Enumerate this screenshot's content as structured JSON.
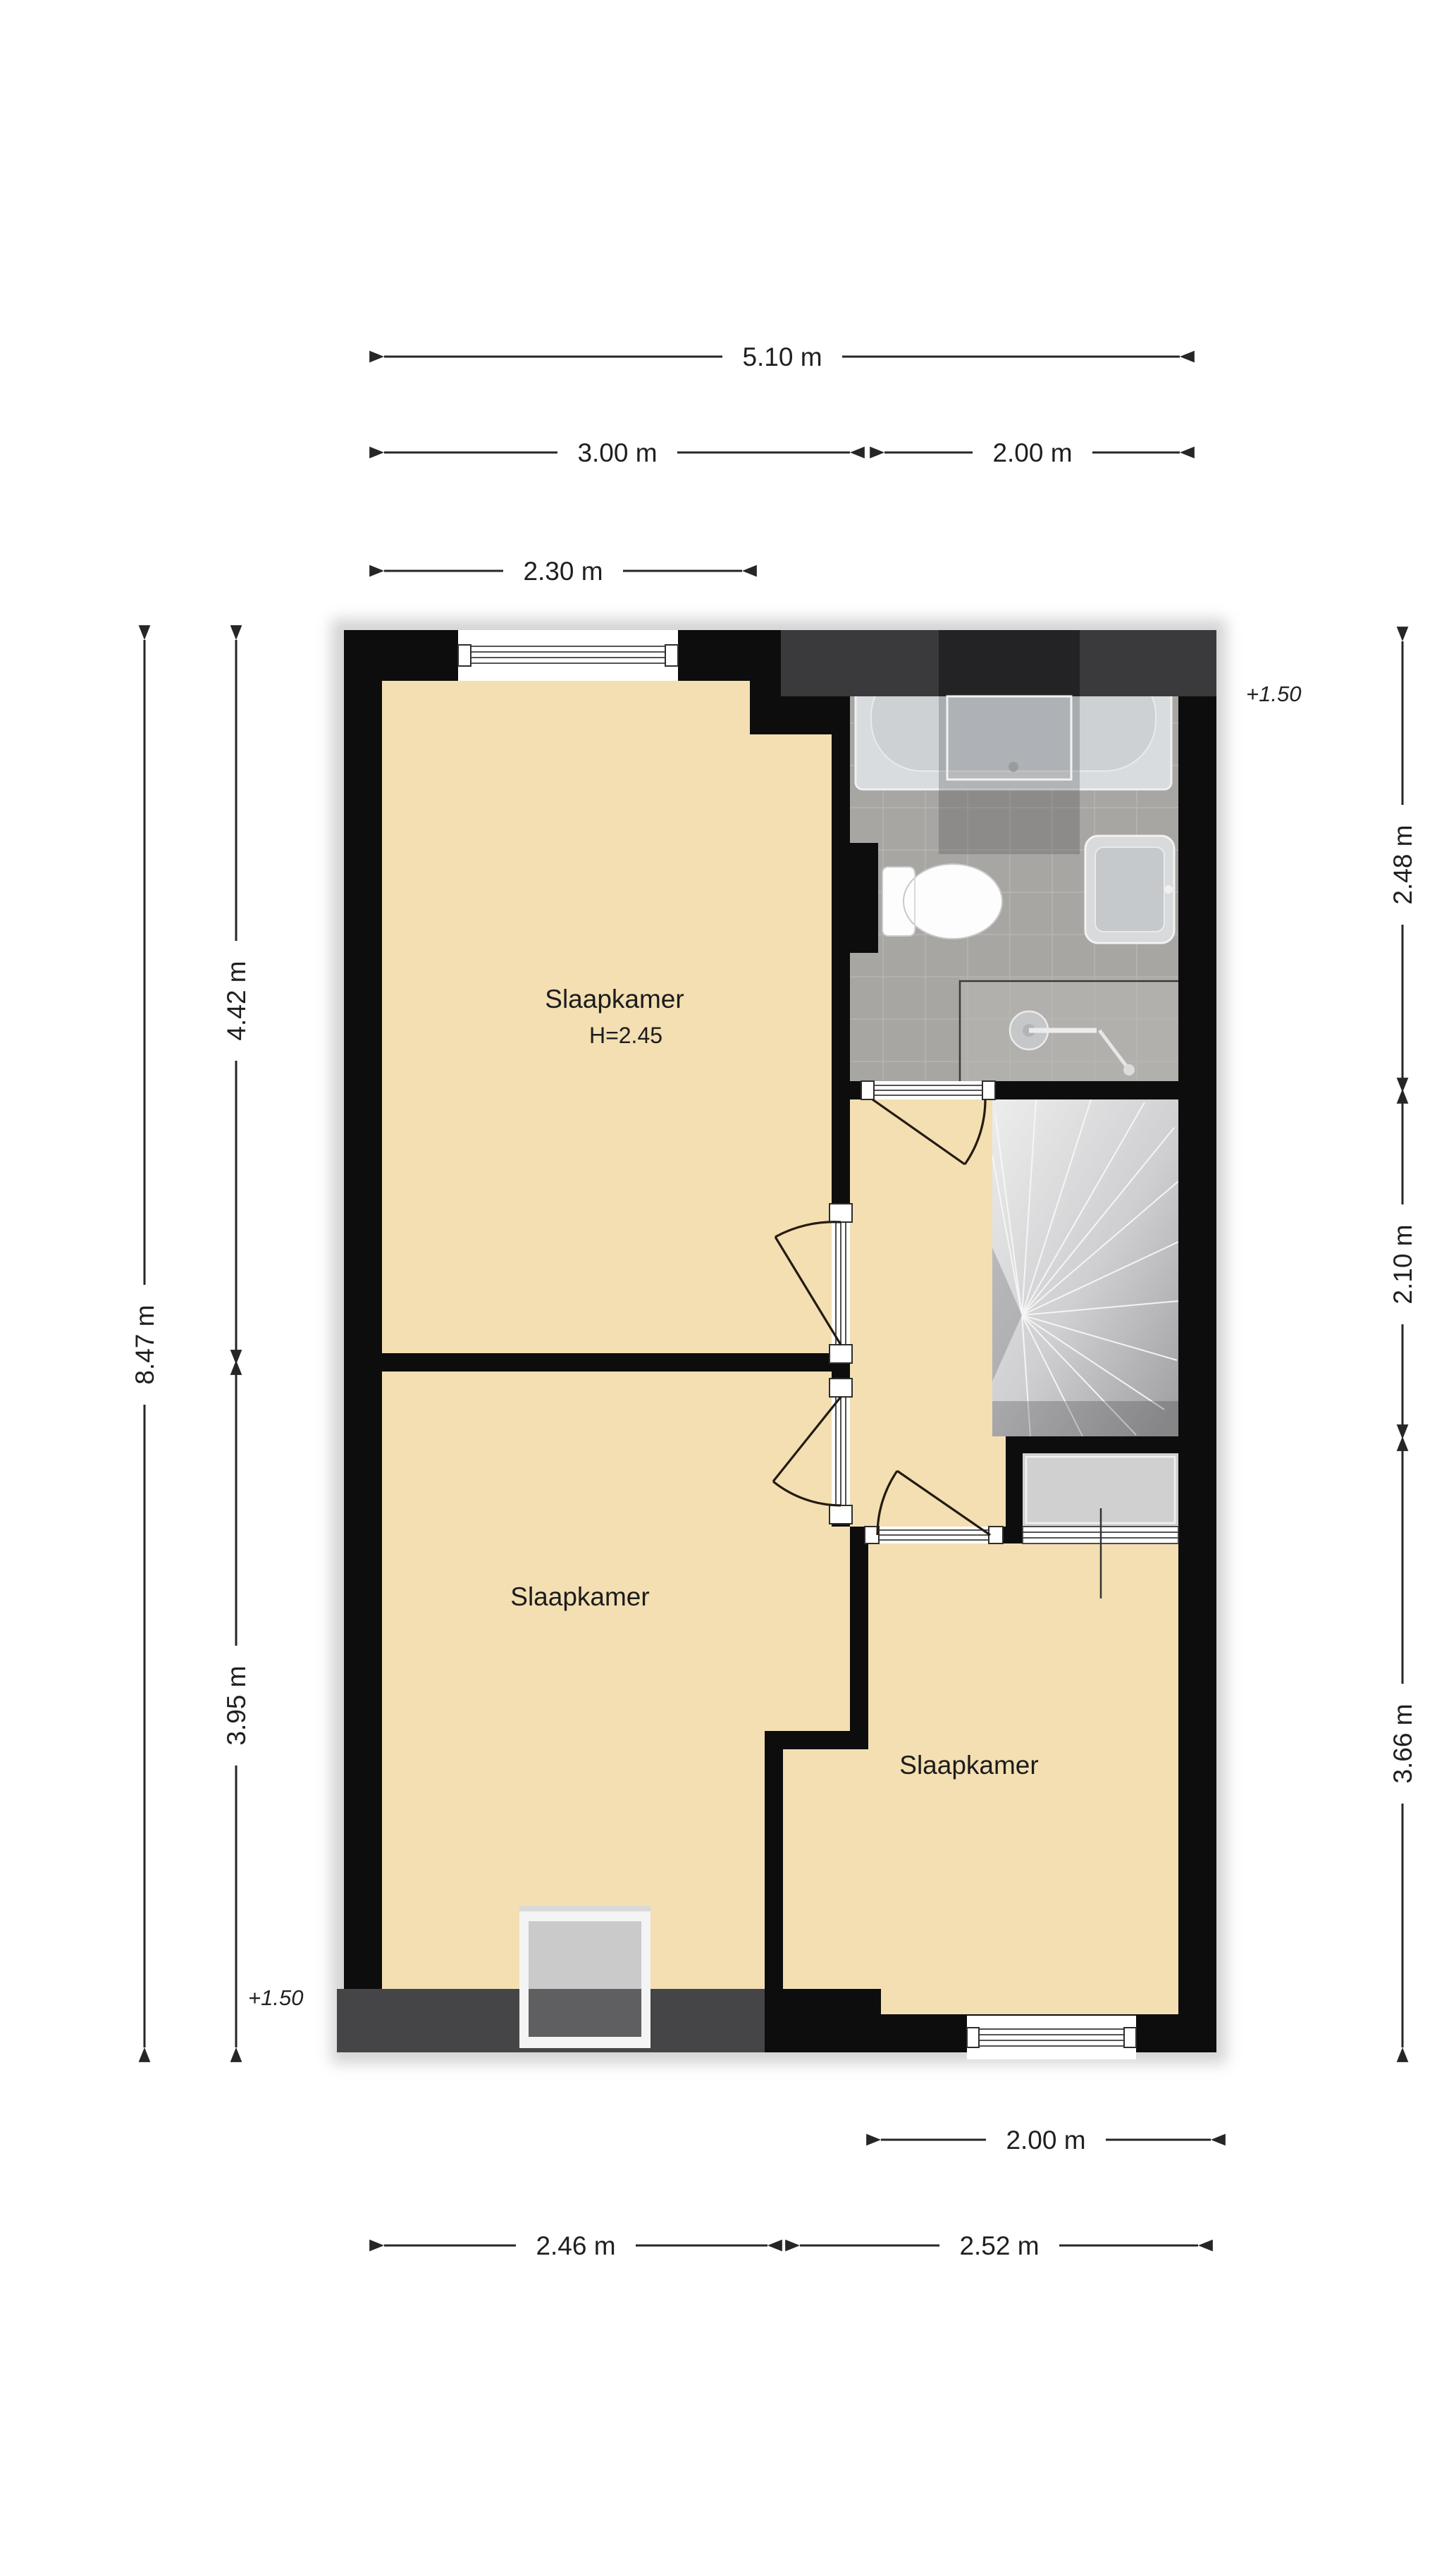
{
  "rooms": [
    {
      "label": "Slaapkamer",
      "ceiling_height": "H=2.45"
    },
    {
      "label": "Slaapkamer"
    },
    {
      "label": "Slaapkamer"
    }
  ],
  "level_markers": [
    {
      "label": "+1.50",
      "position": "top-right"
    },
    {
      "label": "+1.50",
      "position": "bottom-left"
    }
  ],
  "dimensions": {
    "top": [
      {
        "label": "5.10 m"
      },
      {
        "label": "3.00 m"
      },
      {
        "label": "2.00 m"
      },
      {
        "label": "2.30 m"
      }
    ],
    "left": [
      {
        "label": "8.47 m"
      },
      {
        "label": "4.42 m"
      },
      {
        "label": "3.95 m"
      }
    ],
    "right": [
      {
        "label": "2.48 m"
      },
      {
        "label": "2.10 m"
      },
      {
        "label": "3.66 m"
      }
    ],
    "bottom": [
      {
        "label": "2.00 m"
      },
      {
        "label": "2.46 m"
      },
      {
        "label": "2.52 m"
      }
    ]
  },
  "fixtures": [
    "bathtub",
    "toilet",
    "washbasin",
    "shower-head",
    "spiral-staircase",
    "closet",
    "dormer-window",
    "roof-slope-zone"
  ],
  "colors": {
    "floor": "#F3DFB2",
    "wall": "#0D0D0D",
    "tile": "#A8A6A3",
    "tile_light": "#B2B0AD",
    "grout": "#BCBAB7",
    "roof_band": "#3A3A3D",
    "roof_zone": "#454548",
    "closet": "#D0D0D0",
    "dim_text": "#1F1F1F"
  }
}
